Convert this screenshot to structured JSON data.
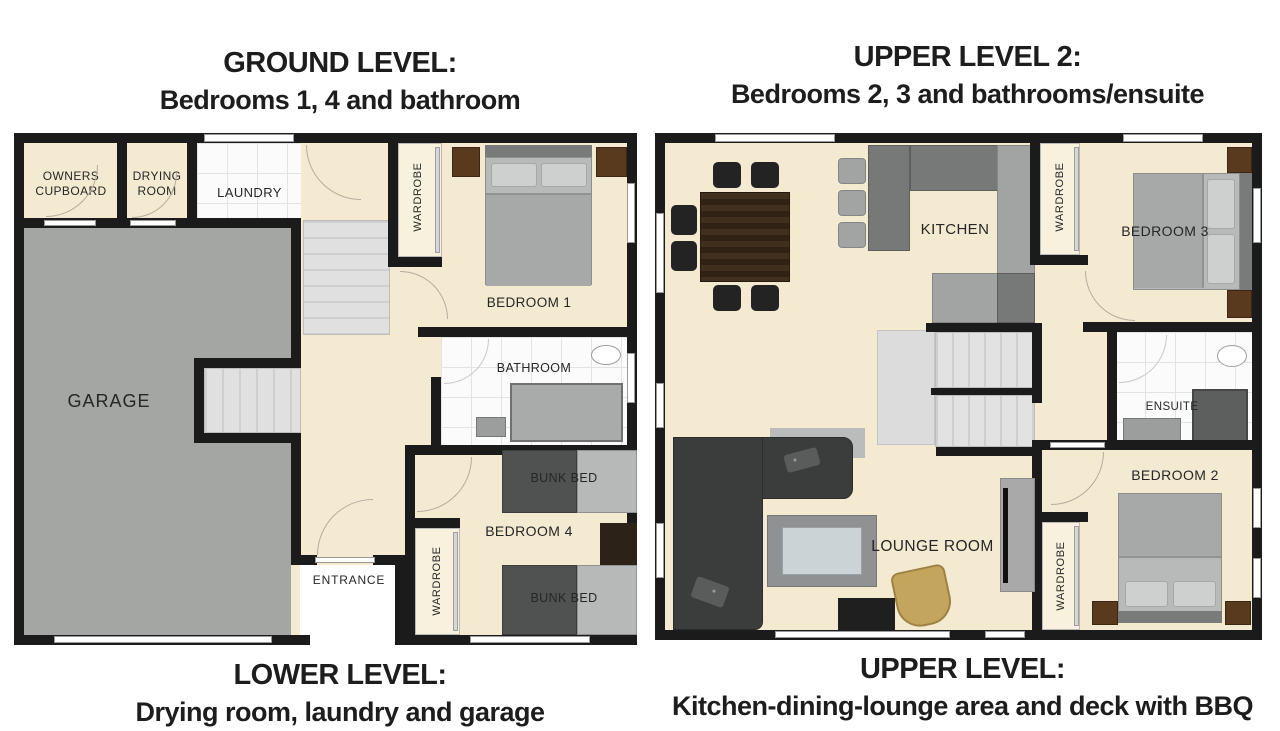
{
  "titles": {
    "left_top_1": "GROUND LEVEL:",
    "left_top_2": "Bedrooms 1, 4 and bathroom",
    "left_bottom_1": "LOWER LEVEL:",
    "left_bottom_2": "Drying room, laundry and garage",
    "right_top_1": "UPPER LEVEL 2:",
    "right_top_2": "Bedrooms 2, 3 and bathrooms/ensuite",
    "right_bottom_1": "UPPER LEVEL:",
    "right_bottom_2": "Kitchen-dining-lounge area and deck with BBQ"
  },
  "ground_level": {
    "owners_cupboard_1": "OWNERS",
    "owners_cupboard_2": "CUPBOARD",
    "drying_room_1": "DRYING",
    "drying_room_2": "ROOM",
    "laundry": "LAUNDRY",
    "wardrobe_bedroom1": "WARDROBE",
    "bedroom1": "BEDROOM 1",
    "garage": "GARAGE",
    "bathroom": "BATHROOM",
    "bunk_bed_top": "BUNK BED",
    "bedroom4": "BEDROOM 4",
    "bunk_bed_bottom": "BUNK BED",
    "wardrobe_bedroom4": "WARDROBE",
    "entrance": "ENTRANCE"
  },
  "upper_level": {
    "kitchen": "KITCHEN",
    "wardrobe_bedroom3": "WARDROBE",
    "bedroom3": "BEDROOM 3",
    "ensuite": "ENSUITE",
    "bedroom2": "BEDROOM 2",
    "wardrobe_bedroom2": "WARDROBE",
    "lounge_room": "LOUNGE ROOM"
  },
  "colors": {
    "wall": "#1b1b1b",
    "floor_cream": "#f3ead1",
    "garage_gray": "#a3a6a3",
    "tile_white": "#fbfbfb",
    "furniture_dark": "#3b3d3c",
    "wood_brown": "#3c2e1f",
    "armchair_tan": "#c4a55e"
  }
}
